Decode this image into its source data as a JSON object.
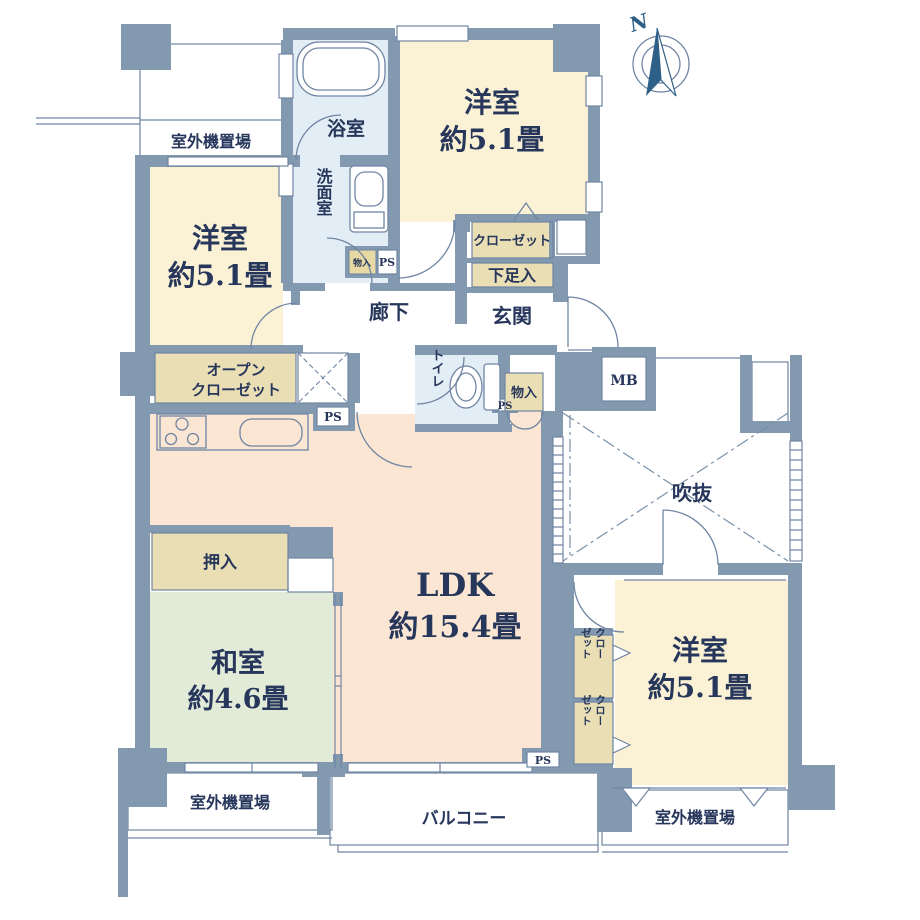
{
  "palette": {
    "wall": "#8299AF",
    "line": "#7085A3",
    "text": "#27365B",
    "room_cream": "#FBF2D5",
    "room_peach": "#FAE6D2",
    "room_green": "#E2EAD8",
    "room_bath_blue": "#E3EDF5",
    "storage_tan": "#EADFB4",
    "compass_blue": "#2E5F86"
  },
  "rooms": {
    "bedroom_top": {
      "name": "洋室",
      "size": "約5.1畳"
    },
    "bedroom_left": {
      "name": "洋室",
      "size": "約5.1畳"
    },
    "bedroom_right": {
      "name": "洋室",
      "size": "約5.1畳"
    },
    "japanese_room": {
      "name": "和室",
      "size": "約4.6畳"
    },
    "ldk": {
      "name": "LDK",
      "size": "約15.4畳"
    },
    "bathroom": {
      "name": "浴室"
    },
    "washroom": {
      "name": "洗面室"
    },
    "hallway": {
      "name": "廊下"
    },
    "entrance": {
      "name": "玄関"
    },
    "toilet": {
      "name": "トイレ"
    },
    "void": {
      "name": "吹抜"
    },
    "balcony": {
      "name": "バルコニー"
    }
  },
  "storage": {
    "closet": "クローゼット",
    "closet_col1": "クロー",
    "closet_col2": "ゼット",
    "shoe_cabinet": "下足入",
    "open_closet_line1": "オープン",
    "open_closet_line2": "クローゼット",
    "oshiire": "押入",
    "monoire": "物入"
  },
  "utility": {
    "meter_box": "MB",
    "pipe_space": "PS",
    "outdoor_unit_area": "室外機置場"
  },
  "compass": {
    "north": "N"
  }
}
